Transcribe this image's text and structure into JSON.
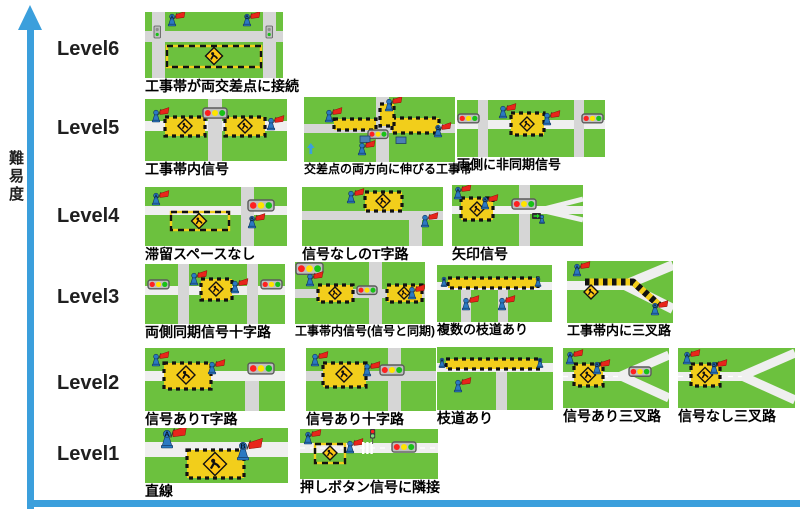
{
  "figure": {
    "y_axis_label": "難易度",
    "levels": [
      {
        "label": "Level6",
        "y": 38
      },
      {
        "label": "Level5",
        "y": 117
      },
      {
        "label": "Level4",
        "y": 205
      },
      {
        "label": "Level3",
        "y": 286
      },
      {
        "label": "Level2",
        "y": 372
      },
      {
        "label": "Level1",
        "y": 443
      }
    ]
  },
  "colors": {
    "axis": "#3B9FDC",
    "grass": "#6CC13E",
    "road": "#D6D6D6",
    "road_light": "#EFEFEF",
    "zone": "#F2CE1B",
    "sign": "#FFC613",
    "flag": "#E8251B",
    "figure": "#2B79C2",
    "red": "#FF2020",
    "yellow": "#FFE400",
    "green": "#17C117",
    "housing": "#BFBFBF",
    "housing_border": "#5A5A5A",
    "ink": "#111111"
  },
  "tiles": [
    {
      "id": "l6-1",
      "label": "工事帯が両交差点に接続",
      "x": 145,
      "y": 12,
      "w": 138,
      "h": 66,
      "cap": 14,
      "scene": [
        [
          "bg"
        ],
        [
          "hroad",
          19,
          11
        ],
        [
          "vroad",
          7,
          13
        ],
        [
          "vroad",
          118,
          13
        ],
        [
          "zoneD",
          22,
          34,
          94,
          21
        ],
        [
          "sign",
          69,
          44,
          17
        ],
        [
          "sigV",
          9,
          14
        ],
        [
          "sigV",
          121,
          14
        ],
        [
          "flag",
          27,
          2,
          1,
          "A"
        ],
        [
          "flag",
          102,
          2,
          1,
          "B"
        ]
      ]
    },
    {
      "id": "l5-1",
      "label": "工事帯内信号",
      "x": 145,
      "y": 99,
      "w": 142,
      "h": 62,
      "cap": 14,
      "scene": [
        [
          "bg"
        ],
        [
          "hroad",
          22,
          10,
          1
        ],
        [
          "vroad",
          63,
          14
        ],
        [
          "zoneC",
          20,
          18,
          40,
          19
        ],
        [
          "sign",
          40,
          27,
          14
        ],
        [
          "zoneC",
          80,
          18,
          40,
          19
        ],
        [
          "sign",
          100,
          27,
          14
        ],
        [
          "sigH",
          58,
          9,
          24
        ],
        [
          "flag",
          11,
          11,
          1
        ],
        [
          "flag",
          126,
          19,
          1
        ]
      ]
    },
    {
      "id": "l5-2",
      "label": "交差点の両方向に伸びる工事帯",
      "x": 304,
      "y": 97,
      "w": 151,
      "h": 65,
      "cap": 12,
      "scene": [
        [
          "bg"
        ],
        [
          "vroad",
          72,
          13
        ],
        [
          "hroad",
          27,
          9
        ],
        [
          "zoneC",
          30,
          22,
          42,
          11
        ],
        [
          "zoneC",
          88,
          21,
          47,
          15
        ],
        [
          "zoneC",
          76,
          7,
          14,
          22
        ],
        [
          "sigH",
          64,
          33,
          20
        ],
        [
          "vehicle",
          56,
          39
        ],
        [
          "vehicle",
          92,
          40
        ],
        [
          "uparrow",
          3,
          46
        ],
        [
          "flag",
          25,
          13,
          1
        ],
        [
          "flag",
          85,
          2,
          1
        ],
        [
          "flag",
          134,
          28,
          1,
          "B"
        ],
        [
          "flag",
          58,
          46,
          1
        ]
      ]
    },
    {
      "id": "l5-3",
      "label": "両側に非同期信号",
      "x": 457,
      "y": 100,
      "w": 148,
      "h": 57,
      "cap": 13,
      "scene": [
        [
          "bg"
        ],
        [
          "hroad",
          20,
          9,
          1
        ],
        [
          "vroad",
          21,
          10
        ],
        [
          "vroad",
          117,
          10
        ],
        [
          "sigH",
          1,
          14,
          21
        ],
        [
          "sigH",
          125,
          14,
          21
        ],
        [
          "zoneC",
          54,
          13,
          33,
          22
        ],
        [
          "sign",
          70,
          24,
          14
        ],
        [
          "flag",
          46,
          6,
          1
        ],
        [
          "flag",
          90,
          13,
          1
        ]
      ]
    },
    {
      "id": "l4-1",
      "label": "滞留スペースなし",
      "x": 145,
      "y": 187,
      "w": 142,
      "h": 59,
      "cap": 14,
      "scene": [
        [
          "bg"
        ],
        [
          "hroad",
          19,
          9,
          1
        ],
        [
          "vroad",
          96,
          13
        ],
        [
          "zoneD",
          26,
          25,
          58,
          18
        ],
        [
          "sign",
          54,
          34,
          15
        ],
        [
          "sigH",
          103,
          13,
          26
        ],
        [
          "flag",
          11,
          6,
          1,
          "A"
        ],
        [
          "flag",
          107,
          29,
          1,
          "B"
        ]
      ]
    },
    {
      "id": "l4-2",
      "label": "信号なしのT字路",
      "x": 302,
      "y": 187,
      "w": 141,
      "h": 59,
      "cap": 14,
      "scene": [
        [
          "bg"
        ],
        [
          "hroad",
          24,
          9
        ],
        [
          "vroad",
          107,
          13,
          33,
          59
        ],
        [
          "zoneC",
          63,
          5,
          37,
          19
        ],
        [
          "sign",
          81,
          14,
          14
        ],
        [
          "flag",
          49,
          4,
          1
        ],
        [
          "flag",
          123,
          28,
          1
        ]
      ]
    },
    {
      "id": "l4-3",
      "label": "矢印信号",
      "x": 452,
      "y": 185,
      "w": 131,
      "h": 61,
      "cap": 14,
      "scene": [
        [
          "bg"
        ],
        [
          "vroad",
          67,
          11
        ],
        [
          "hroad",
          21,
          8,
          1
        ],
        [
          "droad",
          88,
          25,
          131,
          14,
          5
        ],
        [
          "droad",
          88,
          25,
          131,
          35,
          5
        ],
        [
          "zoneC",
          9,
          13,
          32,
          22
        ],
        [
          "sign",
          25,
          24,
          14
        ],
        [
          "sigH",
          60,
          14,
          24
        ],
        [
          "garrow",
          80,
          28
        ],
        [
          "flag",
          6,
          2,
          1,
          "A"
        ],
        [
          "flag",
          33,
          12,
          1,
          "B"
        ],
        [
          "fig",
          90,
          30,
          0.7
        ]
      ]
    },
    {
      "id": "l3-1",
      "label": "両側同期信号十字路",
      "x": 145,
      "y": 264,
      "w": 140,
      "h": 60,
      "cap": 14,
      "scene": [
        [
          "bg"
        ],
        [
          "hroad",
          22,
          9,
          1
        ],
        [
          "vroad",
          33,
          11
        ],
        [
          "vroad",
          102,
          11
        ],
        [
          "sigH",
          3,
          16,
          21
        ],
        [
          "sigH",
          116,
          16,
          21
        ],
        [
          "zoneC",
          56,
          15,
          31,
          21
        ],
        [
          "sign",
          71,
          25,
          14
        ],
        [
          "flag",
          49,
          9,
          1
        ],
        [
          "flag",
          90,
          17,
          1
        ]
      ]
    },
    {
      "id": "l3-2",
      "label": "工事帯内信号(信号と同期)",
      "x": 295,
      "y": 262,
      "w": 130,
      "h": 62,
      "cap": 12,
      "scene": [
        [
          "bg"
        ],
        [
          "hroad",
          27,
          9
        ],
        [
          "vroad",
          74,
          13
        ],
        [
          "sigH",
          1,
          1,
          27
        ],
        [
          "zoneC",
          23,
          23,
          35,
          17
        ],
        [
          "sign",
          40,
          31,
          12
        ],
        [
          "zoneC",
          92,
          23,
          35,
          17
        ],
        [
          "sign",
          109,
          31,
          12
        ],
        [
          "sigH",
          62,
          24,
          20
        ],
        [
          "flag",
          15,
          12,
          1
        ],
        [
          "flag",
          117,
          25,
          1
        ]
      ]
    },
    {
      "id": "l3-3",
      "label": "複数の枝道あり",
      "x": 437,
      "y": 265,
      "w": 115,
      "h": 57,
      "cap": 13,
      "scene": [
        [
          "bg"
        ],
        [
          "hroad",
          17,
          8,
          1
        ],
        [
          "vroad",
          24,
          10,
          25,
          57
        ],
        [
          "vroad",
          61,
          10,
          25,
          57
        ],
        [
          "zoneC",
          11,
          13,
          90,
          10
        ],
        [
          "fig",
          7,
          12,
          0.8,
          "A"
        ],
        [
          "fig",
          101,
          12,
          0.8,
          "B"
        ],
        [
          "flag",
          29,
          33,
          1
        ],
        [
          "flag",
          65,
          33,
          1
        ]
      ]
    },
    {
      "id": "l3-4",
      "label": "工事帯内に三叉路",
      "x": 567,
      "y": 261,
      "w": 106,
      "h": 62,
      "cap": 13,
      "scene": [
        [
          "bg"
        ],
        [
          "hroad",
          20,
          9,
          1,
          0,
          62
        ],
        [
          "droad",
          58,
          24,
          106,
          4,
          10
        ],
        [
          "droad",
          58,
          24,
          106,
          48,
          10
        ],
        [
          "corridor",
          7,
          18,
          21,
          66,
          21,
          92,
          44
        ],
        [
          "sign",
          24,
          31,
          14
        ],
        [
          "flag",
          10,
          3,
          1,
          "A"
        ],
        [
          "flag",
          88,
          42,
          1,
          "B"
        ]
      ]
    },
    {
      "id": "l2-1",
      "label": "信号ありT字路",
      "x": 145,
      "y": 348,
      "w": 140,
      "h": 63,
      "cap": 14,
      "scene": [
        [
          "bg"
        ],
        [
          "hroad",
          23,
          10,
          1
        ],
        [
          "vroad",
          100,
          14,
          33,
          63
        ],
        [
          "sigH",
          103,
          15,
          26
        ],
        [
          "zoneC",
          19,
          15,
          47,
          26
        ],
        [
          "sign",
          41,
          27,
          18
        ],
        [
          "flag",
          11,
          6,
          1
        ],
        [
          "flag",
          67,
          14,
          1
        ]
      ]
    },
    {
      "id": "l2-2",
      "label": "信号あり十字路",
      "x": 306,
      "y": 348,
      "w": 130,
      "h": 63,
      "cap": 14,
      "scene": [
        [
          "bg"
        ],
        [
          "hroad",
          23,
          10
        ],
        [
          "vroad",
          82,
          13
        ],
        [
          "sigH",
          74,
          17,
          24
        ],
        [
          "zoneC",
          17,
          15,
          43,
          24
        ],
        [
          "sign",
          38,
          26,
          16
        ],
        [
          "flag",
          9,
          6,
          1
        ],
        [
          "flag",
          61,
          16,
          1
        ]
      ]
    },
    {
      "id": "l2-3",
      "label": "枝道あり",
      "x": 437,
      "y": 347,
      "w": 116,
      "h": 63,
      "cap": 14,
      "scene": [
        [
          "bg"
        ],
        [
          "hroad",
          16,
          9,
          1
        ],
        [
          "vroad",
          59,
          11,
          25,
          63
        ],
        [
          "zoneC",
          9,
          12,
          94,
          10
        ],
        [
          "fig",
          5,
          11,
          0.8,
          "A"
        ],
        [
          "fig",
          103,
          11,
          0.8,
          "B"
        ],
        [
          "flag",
          21,
          33,
          1
        ]
      ]
    },
    {
      "id": "l2-4",
      "label": "信号あり三叉路",
      "x": 563,
      "y": 348,
      "w": 106,
      "h": 60,
      "cap": 14,
      "scene": [
        [
          "bg"
        ],
        [
          "hroad",
          24,
          9,
          1,
          0,
          62
        ],
        [
          "cline",
          28.5,
          0,
          58
        ],
        [
          "droad",
          58,
          28,
          106,
          7,
          9
        ],
        [
          "droad",
          58,
          28,
          106,
          50,
          9
        ],
        [
          "sigH",
          66,
          19,
          22
        ],
        [
          "zoneC",
          11,
          16,
          29,
          22
        ],
        [
          "sign",
          25,
          27,
          15
        ],
        [
          "flag",
          7,
          4,
          1,
          "A"
        ],
        [
          "flag",
          34,
          14,
          1,
          "B"
        ]
      ]
    },
    {
      "id": "l2-5",
      "label": "信号なし三叉路",
      "x": 678,
      "y": 348,
      "w": 117,
      "h": 60,
      "cap": 14,
      "scene": [
        [
          "bg"
        ],
        [
          "hroad",
          24,
          9,
          1,
          0,
          70
        ],
        [
          "cline",
          28.5,
          0,
          64
        ],
        [
          "droad",
          64,
          28,
          117,
          5,
          9
        ],
        [
          "droad",
          64,
          28,
          117,
          52,
          9
        ],
        [
          "zoneC",
          13,
          16,
          29,
          22
        ],
        [
          "sign",
          27,
          27,
          15
        ],
        [
          "flag",
          9,
          4,
          1,
          "A"
        ],
        [
          "flag",
          36,
          14,
          1,
          "B"
        ]
      ]
    },
    {
      "id": "l1-1",
      "label": "直線",
      "x": 145,
      "y": 428,
      "w": 143,
      "h": 55,
      "cap": 14,
      "scene": [
        [
          "bg"
        ],
        [
          "hroad",
          14,
          15,
          1
        ],
        [
          "zoneC",
          42,
          22,
          57,
          28
        ],
        [
          "sign",
          70,
          36,
          23
        ],
        [
          "flag",
          22,
          2,
          1.5,
          "A"
        ],
        [
          "flag",
          98,
          14,
          1.5,
          "B"
        ]
      ]
    },
    {
      "id": "l1-2",
      "label": "押しボタン信号に隣接",
      "x": 300,
      "y": 429,
      "w": 138,
      "h": 50,
      "cap": 14,
      "scene": [
        [
          "bg"
        ],
        [
          "hroad",
          14,
          10,
          1
        ],
        [
          "cline",
          19,
          0,
          138
        ],
        [
          "zoneD",
          15,
          15,
          30,
          19
        ],
        [
          "sign",
          30,
          24,
          14
        ],
        [
          "flag",
          8,
          3,
          1,
          "A"
        ],
        [
          "flag",
          50,
          12,
          1
        ],
        [
          "cross",
          62,
          13,
          12
        ],
        [
          "ped",
          70,
          0
        ],
        [
          "sigH",
          92,
          13,
          24
        ]
      ]
    }
  ]
}
